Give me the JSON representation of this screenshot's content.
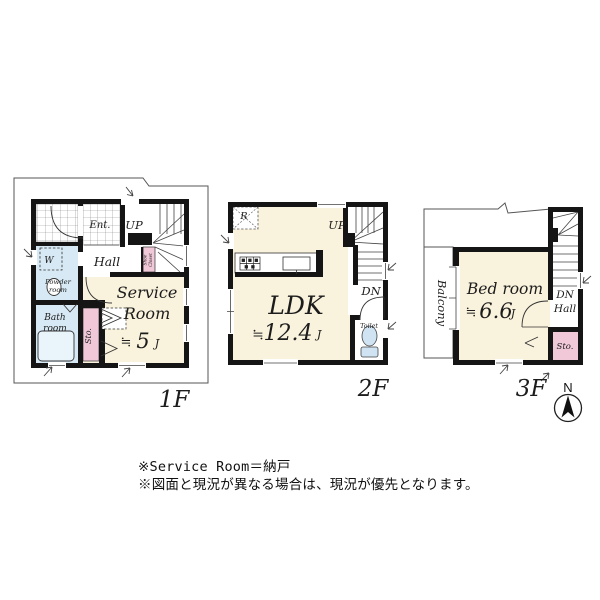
{
  "floors": [
    {
      "name": "1F",
      "labels": {
        "ent": "Ent.",
        "up": "UP",
        "hall": "Hall",
        "shoe_line1": "Shoe",
        "shoe_line2": "Closet",
        "washer": "W",
        "powder_line1": "Powder",
        "powder_line2": "room",
        "bath_line1": "Bath",
        "bath_line2": "room",
        "storage": "Sto.",
        "room_line1": "Service",
        "room_line2": "Room",
        "approx": "≒",
        "size": "5",
        "unit": "J"
      }
    },
    {
      "name": "2F",
      "labels": {
        "fridge": "R",
        "up": "UP",
        "dn": "DN",
        "room": "LDK",
        "approx": "≒",
        "size": "12.4",
        "unit": "J",
        "toilet": "Toilet"
      }
    },
    {
      "name": "3F",
      "labels": {
        "balcony": "Balcony",
        "room": "Bed room",
        "approx": "≒",
        "size": "6.6",
        "unit": "J",
        "dn": "DN",
        "hall": "Hall",
        "storage": "Sto."
      }
    }
  ],
  "compass": {
    "north": "N"
  },
  "notes": {
    "line1": "※Service Room＝納戸",
    "line2": "※図面と現況が異なる場合は、現況が優先となります。"
  },
  "colors": {
    "wall": "#151515",
    "room_cream": "#f9f2dc",
    "wet_blue": "#d7e9f4",
    "storage_pink": "#f1c8d8",
    "thin_line": "#333333"
  }
}
